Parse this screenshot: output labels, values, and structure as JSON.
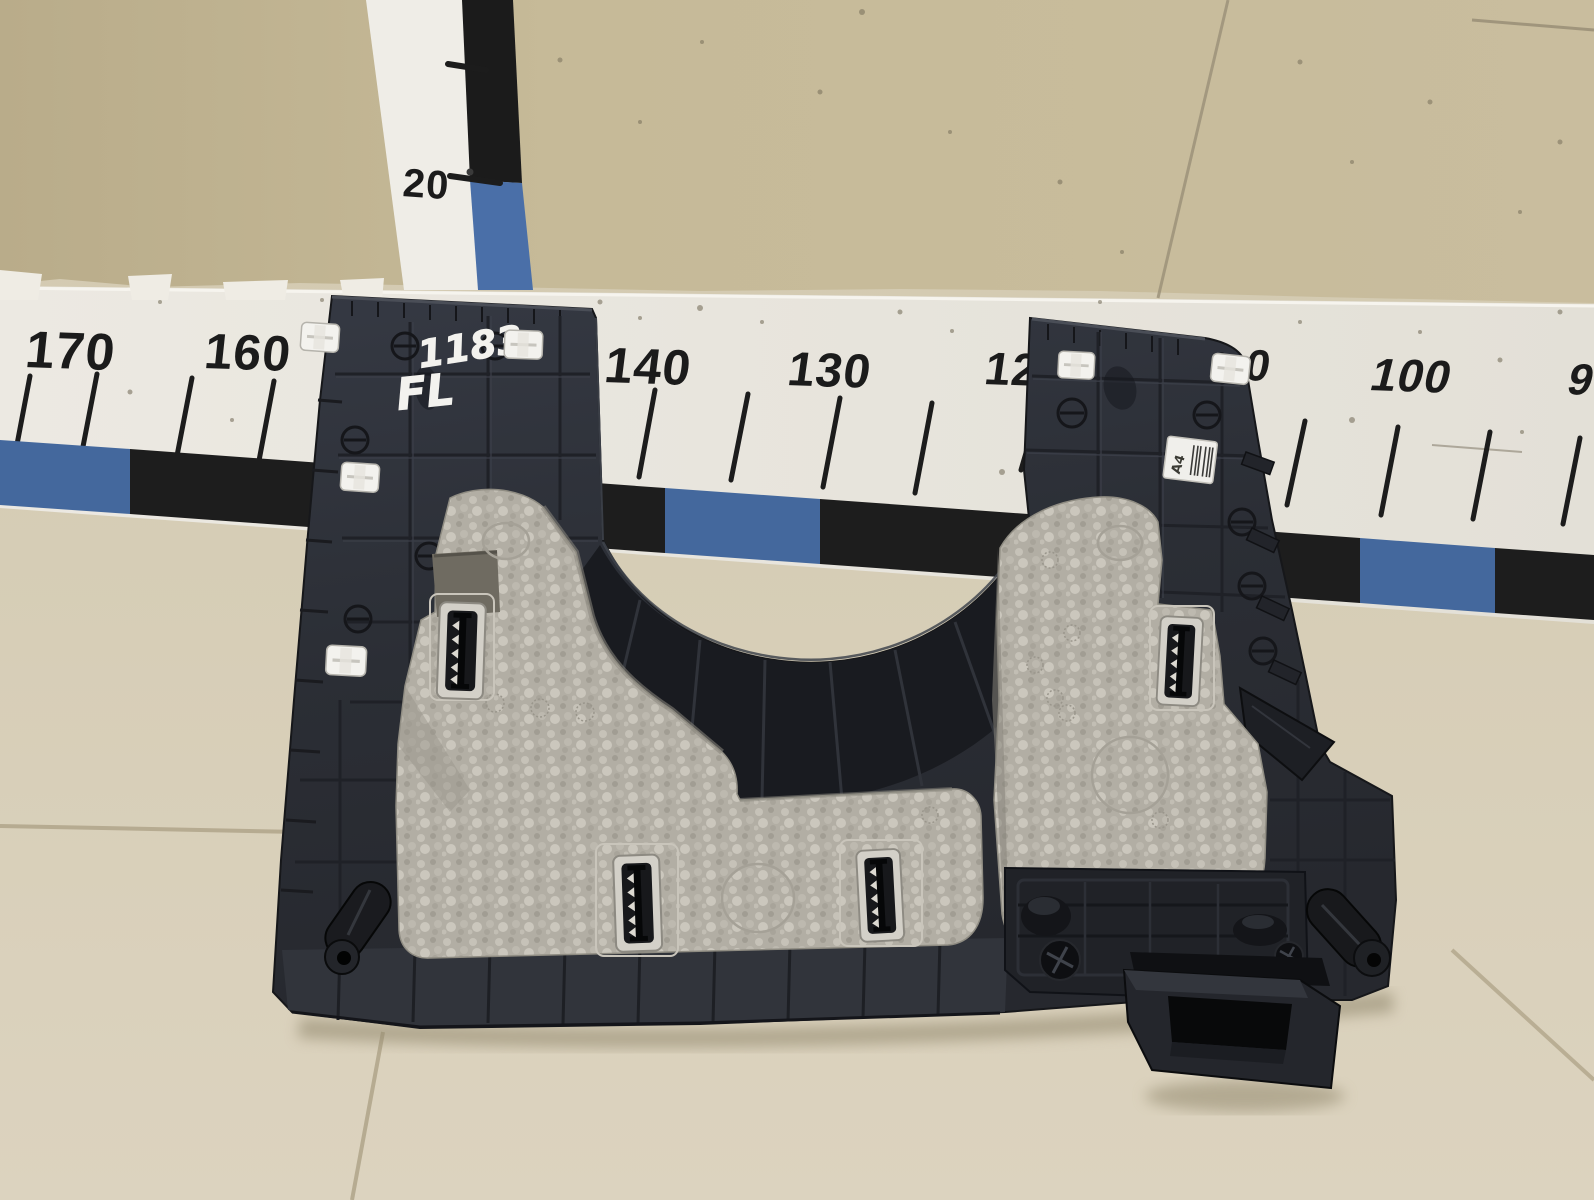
{
  "board": {
    "surface_color": "#eae7e0",
    "band_blue": "#44689d",
    "band_black": "#1d1d1d",
    "numbers": [
      {
        "label": "170"
      },
      {
        "label": "160"
      },
      {
        "label": "140"
      },
      {
        "label": "130"
      },
      {
        "label": "12"
      },
      {
        "label": "0"
      },
      {
        "label": "100"
      },
      {
        "label": "9"
      }
    ]
  },
  "vertical_ruler": {
    "label": "20"
  },
  "part": {
    "handwritten_number": "1183",
    "handwritten_code": "FL",
    "sticker_code": "A4",
    "plastic_color": "#2b2e35",
    "foam_color": "#b3afa5"
  },
  "background": {
    "wall_color": "#c4b795",
    "floor_color": "#d6cdb5"
  }
}
